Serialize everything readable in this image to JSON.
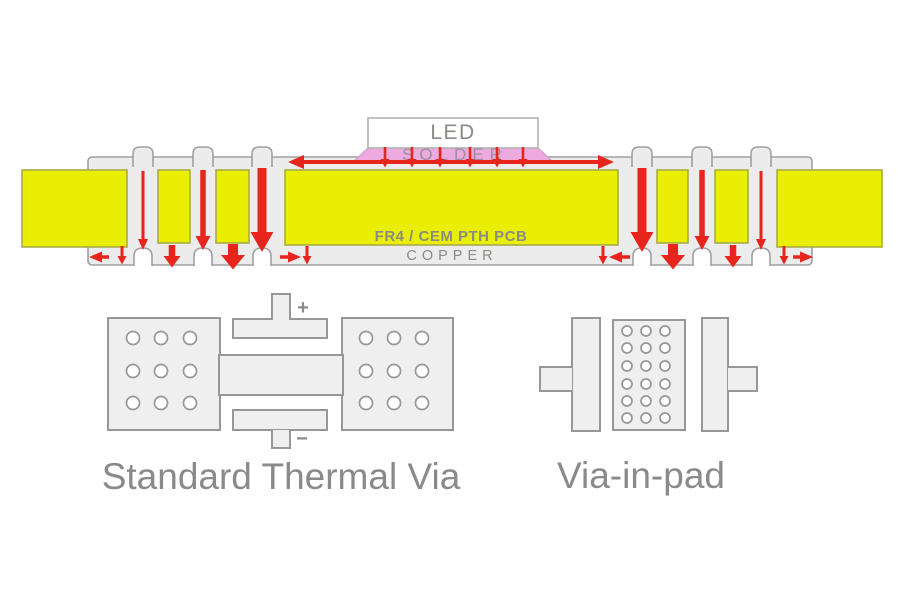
{
  "colors": {
    "background": "#ffffff",
    "arrow_red": "#e8251c",
    "copper_yellow": "#e9ee02",
    "copper_outline": "#a8ac48",
    "board_fill": "#ececec",
    "board_outline": "#a0a0a0",
    "pad_fill": "#efefef",
    "pad_outline": "#979797",
    "solder_pink": "#edaade",
    "solder_outline": "#d69fc9",
    "solder_text": "#9a8fa0",
    "led_outline": "#b3b3b3",
    "text_gray": "#8b8b86",
    "caption_gray": "#8a8a8d"
  },
  "cross_section": {
    "led_label": "LED",
    "solder_label": "SOLDER",
    "substrate_label": "FR4 / CEM PTH PCB",
    "copper_label": "COPPER"
  },
  "diagrams": {
    "standard": {
      "caption": "Standard Thermal Via",
      "plus_label": "+",
      "minus_label": "−"
    },
    "via_in_pad": {
      "caption": "Via-in-pad"
    }
  }
}
